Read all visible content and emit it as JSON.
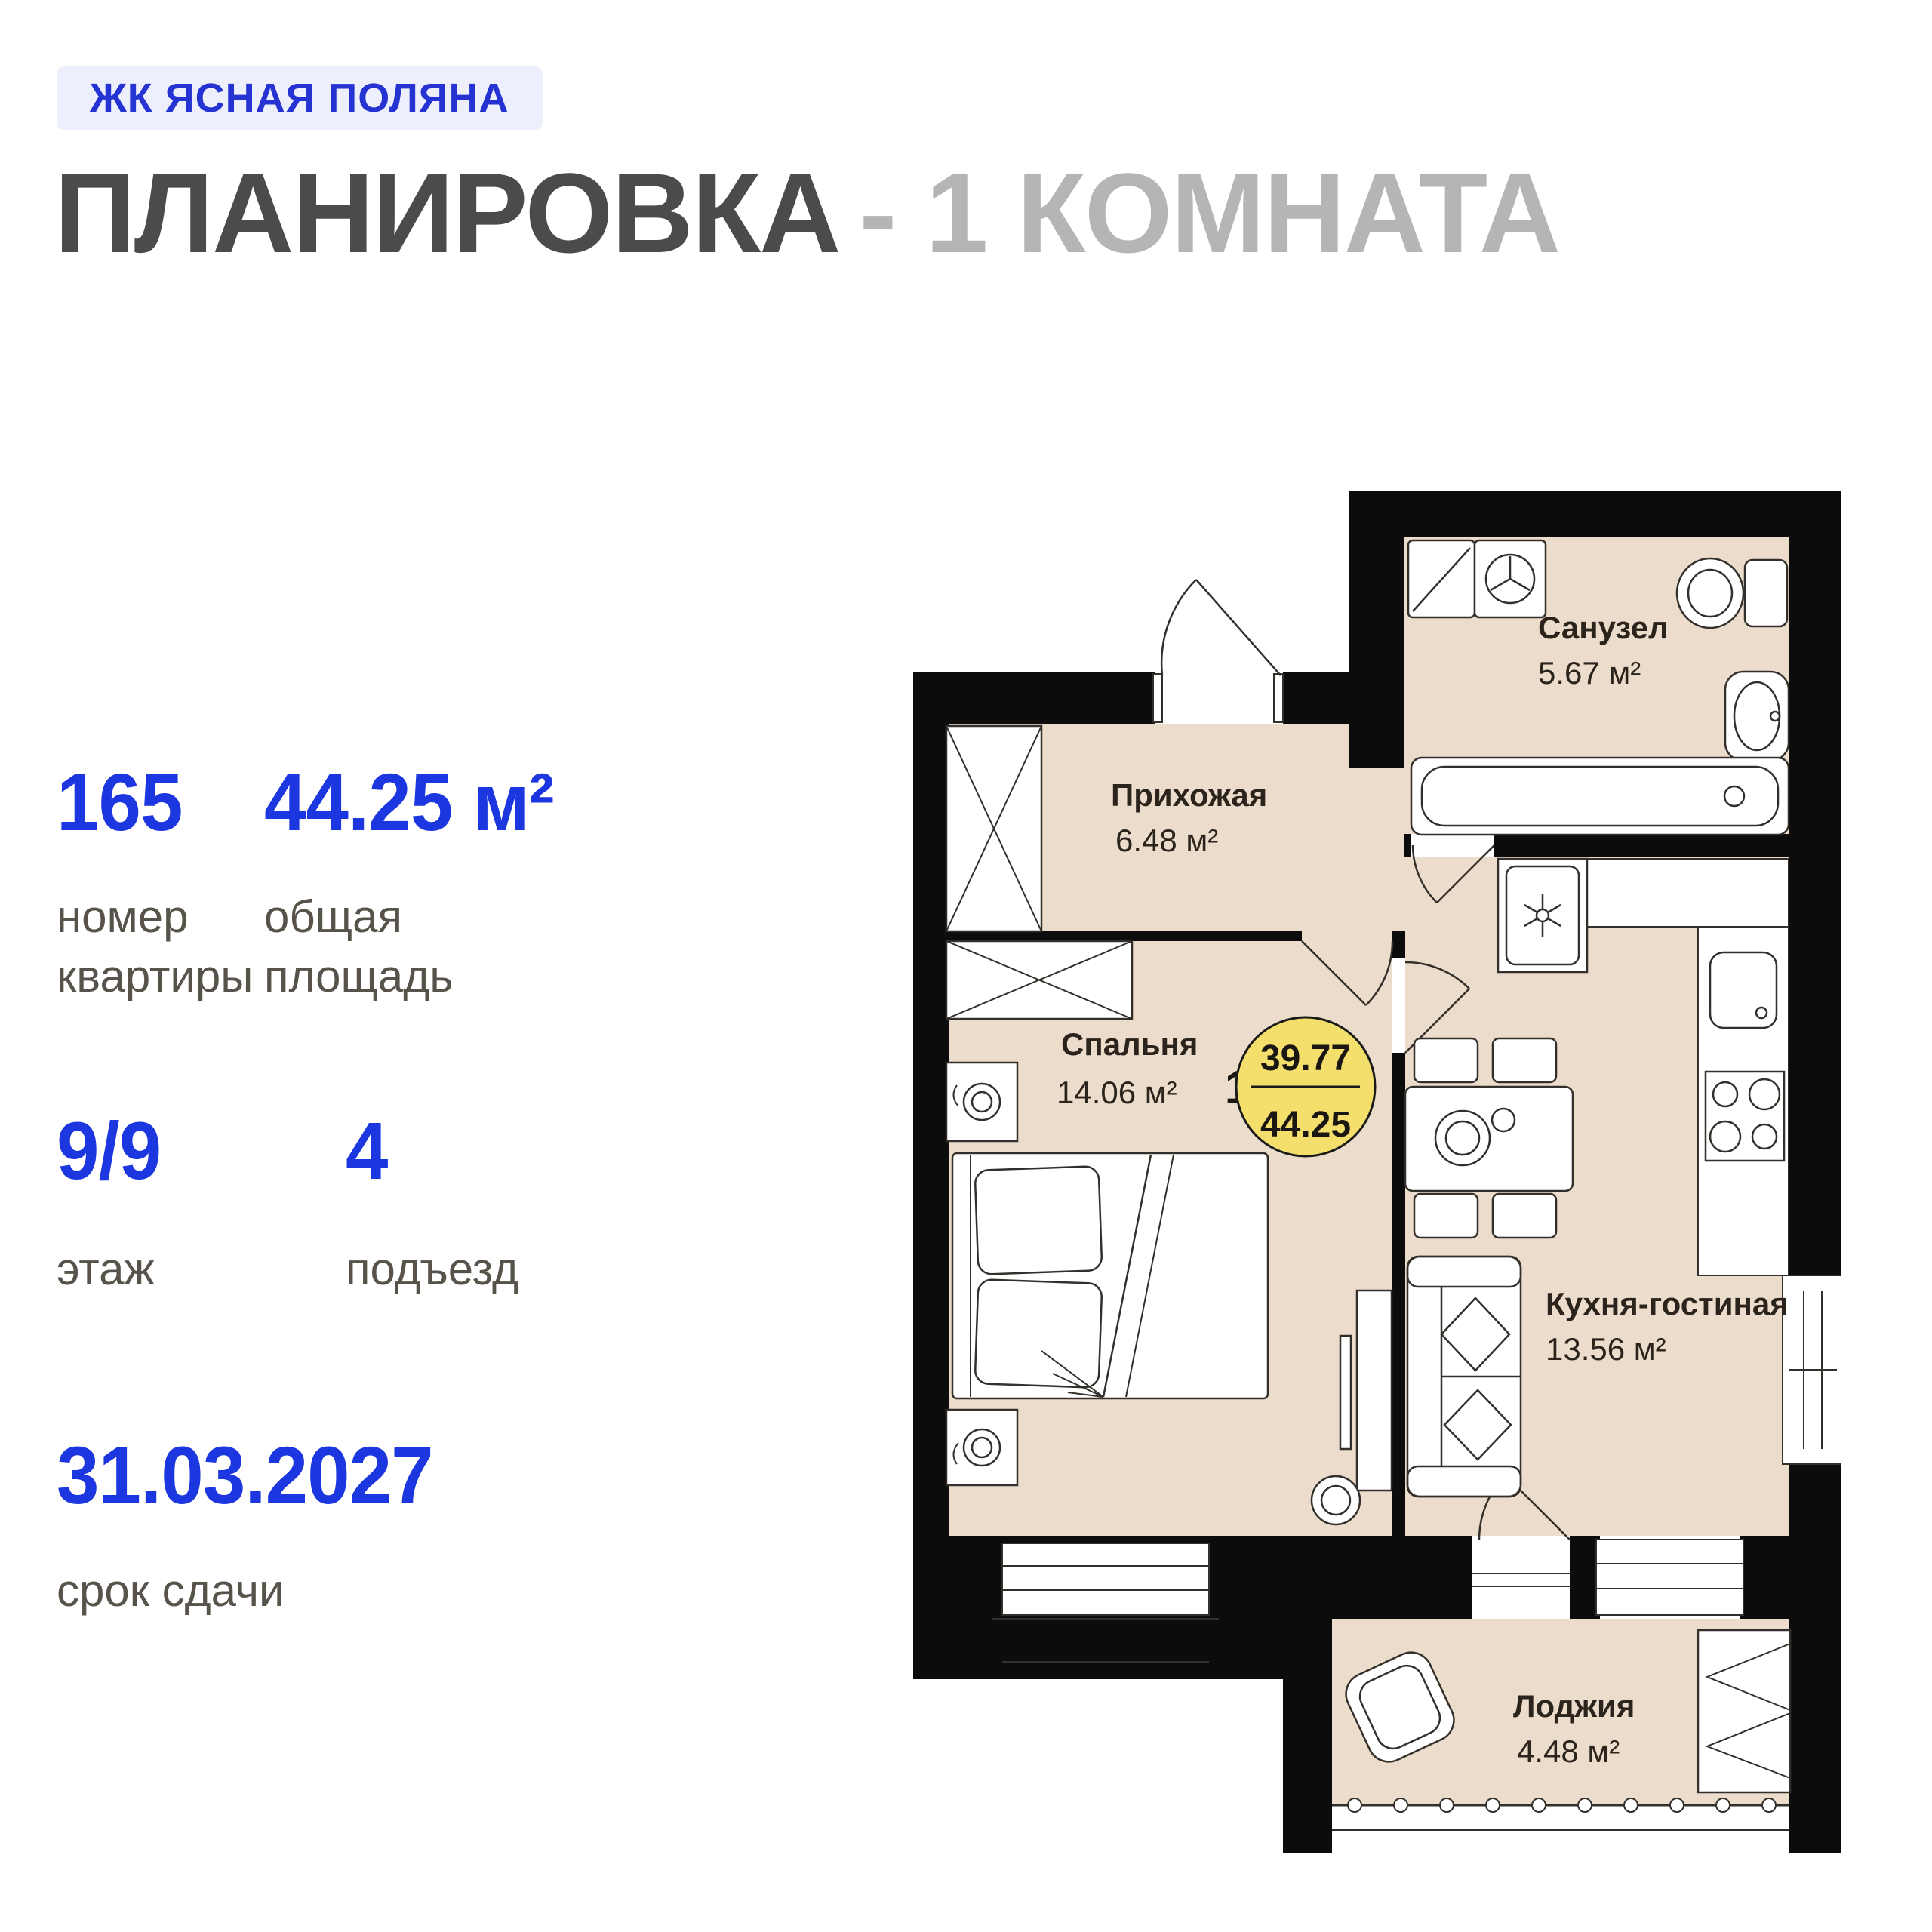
{
  "badge": {
    "label": "ЖК ЯСНАЯ ПОЛЯНА"
  },
  "title": {
    "main": "ПЛАНИРОВКА",
    "dash": "-",
    "suffix": "1 КОМНАТА"
  },
  "stats": [
    {
      "value": "165",
      "label": "номер квартиры"
    },
    {
      "value": "44.25 м²",
      "label": "общая площадь"
    },
    {
      "value": "9/9",
      "label": "этаж"
    },
    {
      "value": "4",
      "label": "подъезд"
    },
    {
      "value": "31.03.2027",
      "label": "срок сдачи"
    }
  ],
  "floorplan": {
    "rooms": [
      {
        "name": "Санузел",
        "area": "5.67 м²"
      },
      {
        "name": "Прихожая",
        "area": "6.48 м²"
      },
      {
        "name": "Спальня",
        "area": "14.06 м²"
      },
      {
        "name": "Кухня-гостиная",
        "area": "13.56 м²"
      },
      {
        "name": "Лоджия",
        "area": "4.48 м²"
      }
    ],
    "area_badge": {
      "unit_label": "1з",
      "living_area": "39.77",
      "total_area": "44.25"
    },
    "colors": {
      "accent_blue": "#1c36e0",
      "badge_bg": "#edeffc",
      "badge_text": "#2433d2",
      "title_dark": "#4b4b4b",
      "title_light": "#b5b5b5",
      "label_gray": "#57534b",
      "floor_beige": "#ecdccc",
      "wall_black": "#0c0c0c",
      "highlight_yellow": "#f4df6d"
    }
  }
}
